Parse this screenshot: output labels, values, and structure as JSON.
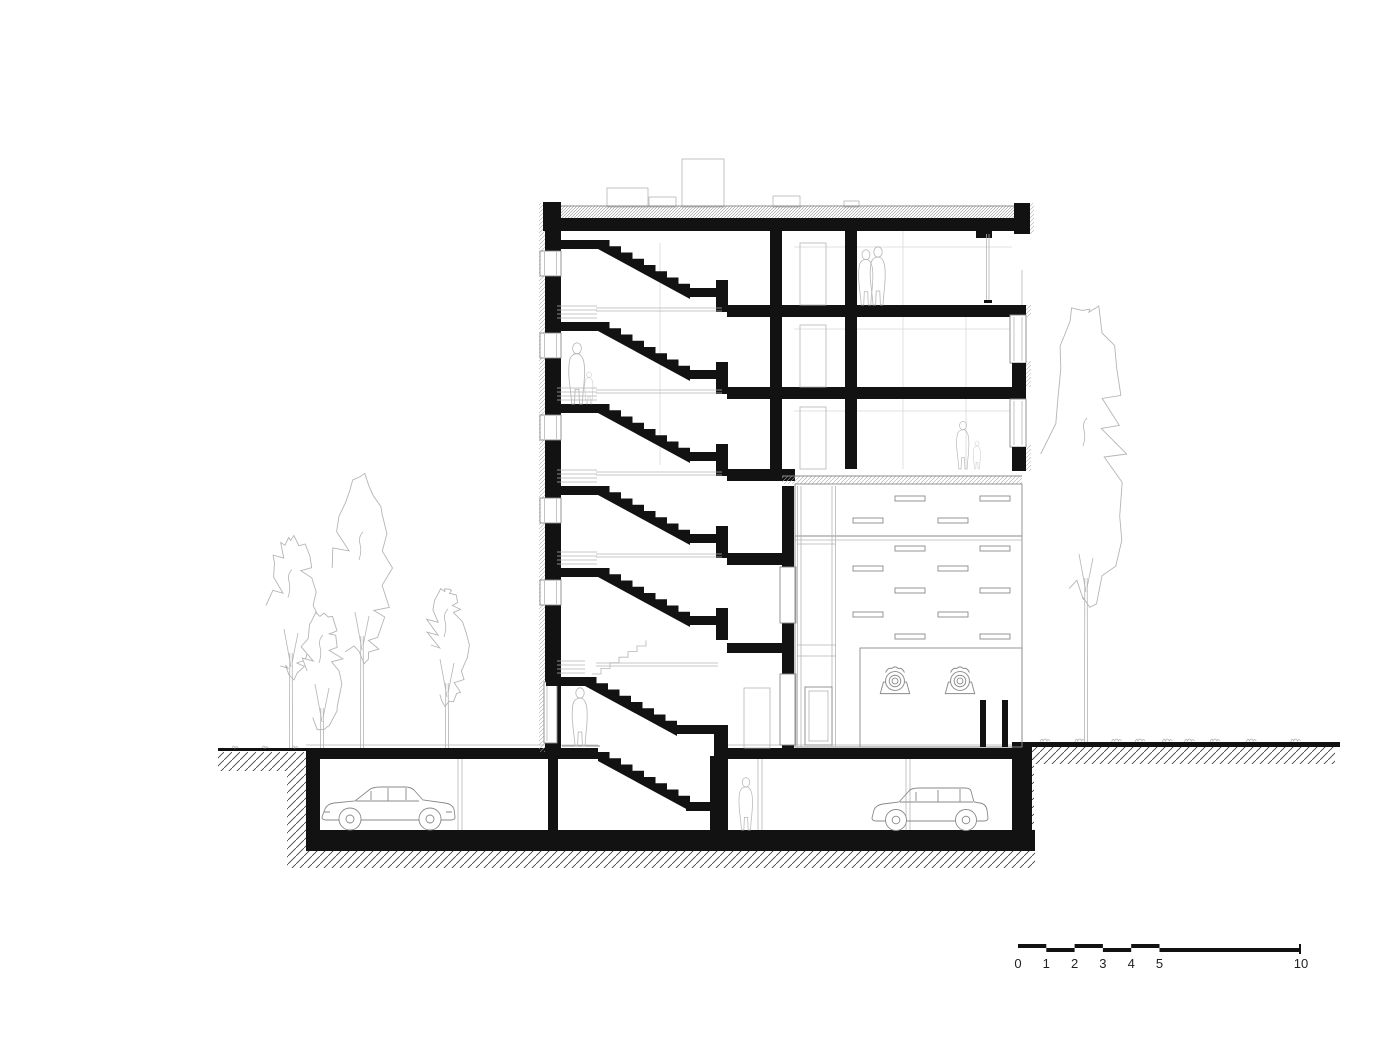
{
  "page": {
    "background": "#ffffff"
  },
  "colors": {
    "ink": "#121212",
    "line_mid": "#8a8a8a",
    "line_light": "#b5b5b5",
    "line_faint": "#d6d6d6",
    "earth_hatch": "#3c3c3c",
    "roof_hatch": "#8f8f8f",
    "text": "#222222"
  },
  "scale_bar": {
    "labels": [
      "0",
      "1",
      "2",
      "3",
      "4",
      "5",
      "10"
    ]
  },
  "elements": {
    "drawing_type": "building-cross-section",
    "building": {
      "stories_above_ground": 6,
      "basement": "parking-garage",
      "stair_flights": 7,
      "annex_wing": "perforated-facade-elevation-with-vent-slots"
    },
    "figures": [
      {
        "name": "couple-top-floor"
      },
      {
        "name": "adult-and-child-on-stair-landing"
      },
      {
        "name": "adult-and-child-third-floor"
      },
      {
        "name": "adult-ground-floor"
      },
      {
        "name": "adult-basement-garage"
      }
    ],
    "vehicles": [
      {
        "name": "sedan-car-basement-left"
      },
      {
        "name": "estate-car-basement-right"
      }
    ],
    "trees": {
      "left_group": 4,
      "right_single": 1
    },
    "wall_lamps": 2
  }
}
